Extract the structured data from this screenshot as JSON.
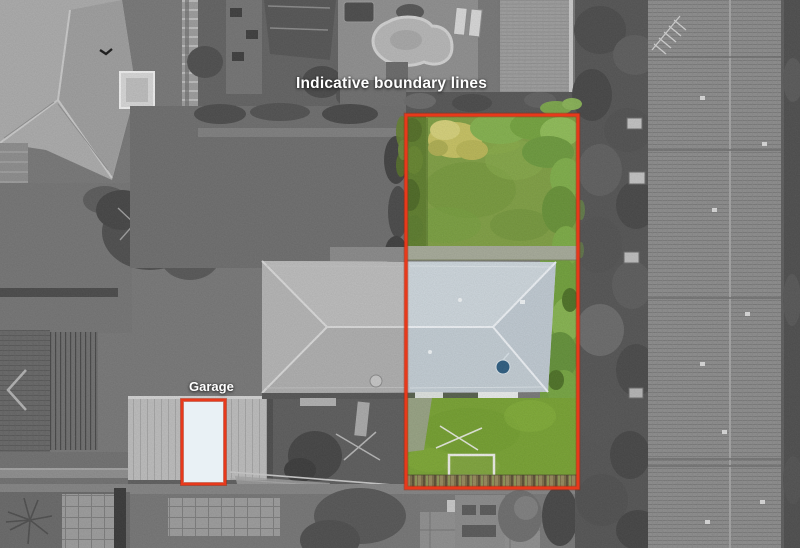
{
  "overlay": {
    "title": "Indicative boundary lines",
    "garage_label": "Garage"
  },
  "colors": {
    "boundary_red": "#e8391b",
    "boundary_red_dark": "#9a2008",
    "lawn_green": "#7f9f44",
    "front_lawn_green": "#78a233",
    "hedge_green": "#5f7e2e",
    "tree_green": "#7fae4a",
    "roof_blue_gray": "#c8d1d8",
    "garage_highlight": "#e9f1f5"
  }
}
